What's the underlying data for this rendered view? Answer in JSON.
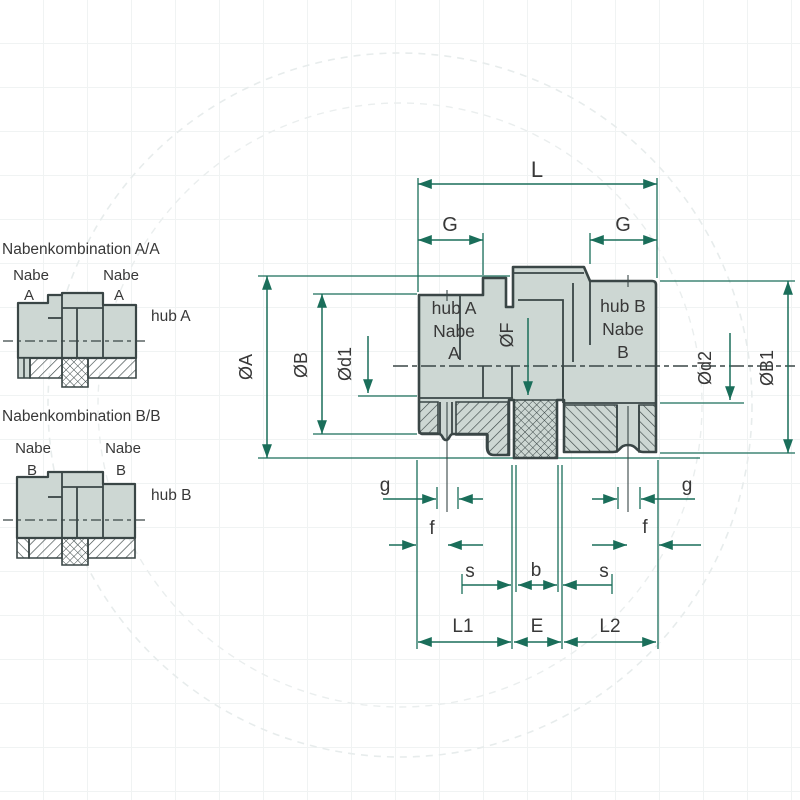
{
  "colors": {
    "background": "#ffffff",
    "part_fill": "#cdd7d3",
    "outline": "#3a4646",
    "dimension_line": "#1a6e5a",
    "label_text": "#383838",
    "watermark": "#e7ecec"
  },
  "side_figures": {
    "aa": {
      "title": "Nabenkombination A/A",
      "left_hub": "Nabe",
      "left_hub_letter": "A",
      "right_hub": "Nabe",
      "right_hub_letter": "A",
      "side_label": "hub A"
    },
    "bb": {
      "title": "Nabenkombination B/B",
      "left_hub": "Nabe",
      "left_hub_letter": "B",
      "right_hub": "Nabe",
      "right_hub_letter": "B",
      "side_label": "hub B"
    }
  },
  "main_figure": {
    "hub_a": {
      "line1": "hub A",
      "line2": "Nabe",
      "line3": "A"
    },
    "hub_b": {
      "line1": "hub B",
      "line2": "Nabe",
      "line3": "B"
    },
    "dims": {
      "L": "L",
      "G_left": "G",
      "G_right": "G",
      "dia_A": "ØA",
      "dia_B": "ØB",
      "dia_d1": "Ød1",
      "dia_F": "ØF",
      "dia_d2": "Ød2",
      "dia_B1": "ØB1",
      "g_left": "g",
      "g_right": "g",
      "f_left": "f",
      "f_right": "f",
      "s_left": "s",
      "s_right": "s",
      "b": "b",
      "L1": "L1",
      "E": "E",
      "L2": "L2"
    }
  }
}
